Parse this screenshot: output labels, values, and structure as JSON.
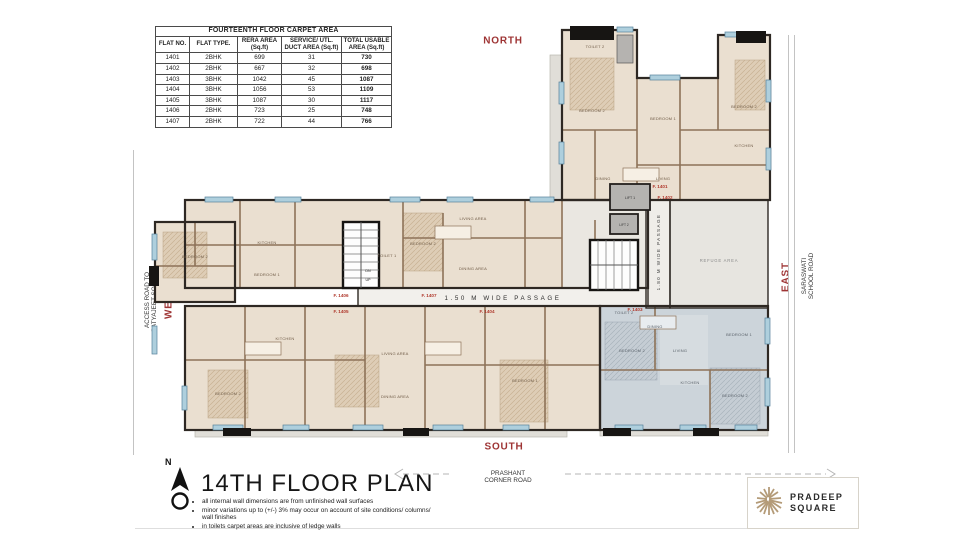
{
  "table": {
    "title": "FOURTEENTH FLOOR CARPET AREA",
    "columns": [
      "FLAT NO.",
      "FLAT TYPE.",
      "RERA AREA\n(Sq.ft)",
      "SERVICE/ UTL.\nDUCT AREA (Sq.ft)",
      "TOTAL USABLE\nAREA (Sq.ft)"
    ],
    "rows": [
      [
        "1401",
        "2BHK",
        "699",
        "31",
        "730"
      ],
      [
        "1402",
        "2BHK",
        "667",
        "32",
        "698"
      ],
      [
        "1403",
        "3BHK",
        "1042",
        "45",
        "1087"
      ],
      [
        "1404",
        "3BHK",
        "1056",
        "53",
        "1109"
      ],
      [
        "1405",
        "3BHK",
        "1087",
        "30",
        "1117"
      ],
      [
        "1406",
        "2BHK",
        "723",
        "25",
        "748"
      ],
      [
        "1407",
        "2BHK",
        "722",
        "44",
        "766"
      ]
    ]
  },
  "compass": {
    "north": "NORTH",
    "south": "SOUTH",
    "east": "EAST",
    "west": "WEST"
  },
  "roads": {
    "west_line1": "ACCESS ROAD TO",
    "west_line2": "SATYAJEET SOCIETY",
    "east_line1": "SARASWATI",
    "east_line2": "SCHOOL ROAD",
    "south_line1": "PRASHANT",
    "south_line2": "CORNER ROAD"
  },
  "plan": {
    "passage_horizontal": "1.50 M WIDE PASSAGE",
    "passage_vertical": "1.80 M WIDE PASSAGE",
    "refuge": "REFUGE AREA",
    "lift1": "LIFT 1",
    "lift2": "LIFT 2",
    "up": "UP",
    "dn": "DN",
    "flats": [
      "F. 1401",
      "F. 1402",
      "F. 1403",
      "F. 1404",
      "F. 1405",
      "F. 1406",
      "F. 1407"
    ],
    "rooms": [
      "TOILET 2",
      "BEDROOM 2",
      "BEDROOM 1",
      "BEDROOM 2",
      "KITCHEN",
      "LIVING",
      "DINING",
      "BEDROOM 2",
      "KITCHEN",
      "BEDROOM 1",
      "LIVING AREA",
      "DINING AREA",
      "BEDROOM 2",
      "TOILET 1",
      "BEDROOM 2",
      "KITCHEN",
      "LIVING AREA",
      "DINING AREA",
      "BEDROOM 1",
      "BEDROOM 2",
      "LIVING",
      "DINING",
      "KITCHEN",
      "BEDROOM 1",
      "BEDROOM 2",
      "TOILET 2"
    ]
  },
  "footer": {
    "north_letter": "N",
    "title": "14TH FLOOR PLAN",
    "notes": [
      "all internal wall dimensions are from unfinished wall surfaces",
      "minor variations up to (+/-) 3% may occur on account of site conditions/ columns/ wall finishes",
      "in toilets carpet areas are inclusive of ledge walls"
    ],
    "logo_line1": "PRADEEP",
    "logo_line2": "SQUARE"
  },
  "colors": {
    "direction_label": "#9e3434",
    "flat_label": "#b03a2e",
    "wall_dark": "#2e2823",
    "wall_brown": "#8d7258",
    "room_fill": "#eadfd0",
    "hatch_fill": "#decdb6",
    "window_blue": "#aecfdd",
    "gray_flat": "#ccd4da",
    "logo_tan": "#b49b78"
  }
}
